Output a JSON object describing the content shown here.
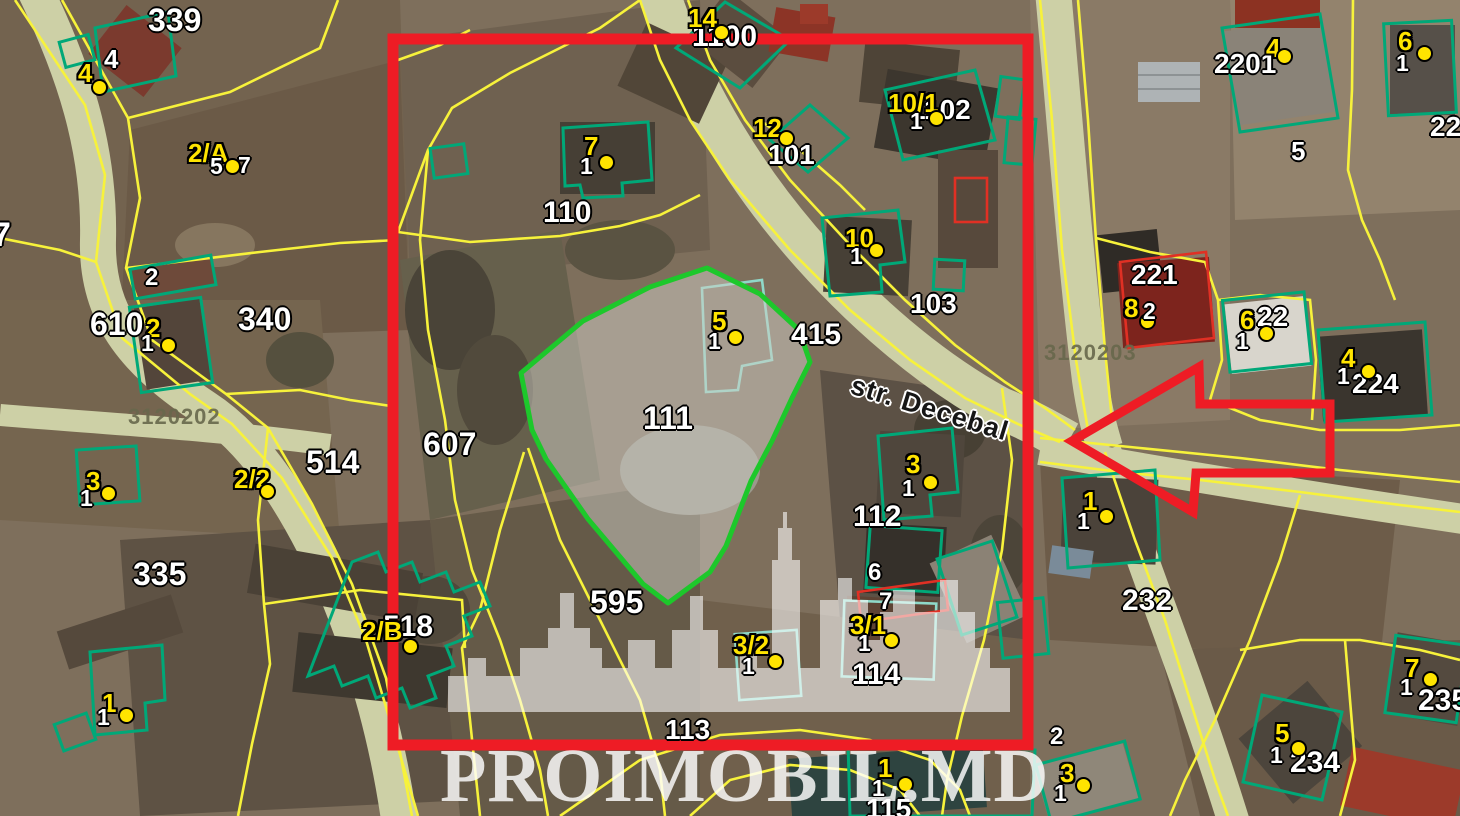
{
  "map": {
    "street_label": "str. Decebal",
    "watermark": {
      "text": "PROIMOBIL.MD"
    },
    "zone_codes": [
      {
        "text": "3120202",
        "x": 128,
        "y": 406
      },
      {
        "text": "3120203",
        "x": 1044,
        "y": 342
      }
    ],
    "colors": {
      "boundary_yellow": "#f7f23b",
      "outline_green": "#00a878",
      "outline_teal": "#8fd8c8",
      "highlight_green": "#1dc82b",
      "alert_red": "#ee1c25",
      "marker_yellow": "#ffe400",
      "label_white": "#ffffff",
      "zone_code_olive": "#68684c",
      "road": "#cdd0a6"
    },
    "markers": [
      {
        "label": "4",
        "lx": 78,
        "ly": 60,
        "dx": 99,
        "dy": 87,
        "subs": []
      },
      {
        "label": "2/A",
        "lx": 188,
        "ly": 140,
        "dx": 232,
        "dy": 166,
        "subs": [
          {
            "t": "5",
            "x": 210,
            "y": 155
          },
          {
            "t": "7",
            "x": 238,
            "y": 154
          }
        ]
      },
      {
        "label": "2",
        "lx": 146,
        "ly": 315,
        "dx": 168,
        "dy": 345,
        "subs": [
          {
            "t": "1",
            "x": 141,
            "y": 332
          }
        ]
      },
      {
        "label": "3",
        "lx": 86,
        "ly": 468,
        "dx": 108,
        "dy": 493,
        "subs": [
          {
            "t": "1",
            "x": 80,
            "y": 487
          }
        ]
      },
      {
        "label": "2/2",
        "lx": 234,
        "ly": 466,
        "dx": 267,
        "dy": 491,
        "subs": []
      },
      {
        "label": "1",
        "lx": 102,
        "ly": 690,
        "dx": 126,
        "dy": 715,
        "subs": [
          {
            "t": "1",
            "x": 97,
            "y": 706
          }
        ]
      },
      {
        "label": "14",
        "lx": 688,
        "ly": 5,
        "dx": 721,
        "dy": 32,
        "subs": []
      },
      {
        "label": "7",
        "lx": 584,
        "ly": 133,
        "dx": 606,
        "dy": 162,
        "subs": [
          {
            "t": "1",
            "x": 580,
            "y": 155
          }
        ]
      },
      {
        "label": "12",
        "lx": 753,
        "ly": 115,
        "dx": 786,
        "dy": 138,
        "subs": []
      },
      {
        "label": "10/1",
        "lx": 888,
        "ly": 90,
        "dx": 936,
        "dy": 118,
        "subs": [
          {
            "t": "1",
            "x": 910,
            "y": 110
          }
        ]
      },
      {
        "label": "10",
        "lx": 845,
        "ly": 225,
        "dx": 876,
        "dy": 250,
        "subs": [
          {
            "t": "1",
            "x": 850,
            "y": 245
          }
        ]
      },
      {
        "label": "5",
        "lx": 712,
        "ly": 308,
        "dx": 735,
        "dy": 337,
        "subs": [
          {
            "t": "1",
            "x": 708,
            "y": 330
          }
        ]
      },
      {
        "label": "3",
        "lx": 906,
        "ly": 451,
        "dx": 930,
        "dy": 482,
        "subs": [
          {
            "t": "1",
            "x": 902,
            "y": 477
          }
        ]
      },
      {
        "label": "3/1",
        "lx": 850,
        "ly": 612,
        "dx": 891,
        "dy": 640,
        "subs": [
          {
            "t": "1",
            "x": 858,
            "y": 632
          }
        ]
      },
      {
        "label": "3/2",
        "lx": 733,
        "ly": 632,
        "dx": 775,
        "dy": 661,
        "subs": [
          {
            "t": "1",
            "x": 742,
            "y": 655
          }
        ]
      },
      {
        "label": "2/B",
        "lx": 362,
        "ly": 618,
        "dx": 410,
        "dy": 646,
        "subs": []
      },
      {
        "label": "1",
        "lx": 878,
        "ly": 755,
        "dx": 905,
        "dy": 784,
        "subs": [
          {
            "t": "1",
            "x": 872,
            "y": 777
          }
        ]
      },
      {
        "label": "3",
        "lx": 1060,
        "ly": 760,
        "dx": 1083,
        "dy": 785,
        "subs": [
          {
            "t": "1",
            "x": 1054,
            "y": 782
          }
        ]
      },
      {
        "label": "8",
        "lx": 1124,
        "ly": 295,
        "dx": 1147,
        "dy": 321,
        "subs": [
          {
            "t": "2",
            "x": 1143,
            "y": 300
          }
        ]
      },
      {
        "label": "6",
        "lx": 1398,
        "ly": 28,
        "dx": 1424,
        "dy": 53,
        "subs": [
          {
            "t": "1",
            "x": 1396,
            "y": 52
          }
        ]
      },
      {
        "label": "4",
        "lx": 1266,
        "ly": 35,
        "dx": 1284,
        "dy": 56,
        "subs": []
      },
      {
        "label": "6",
        "lx": 1240,
        "ly": 307,
        "dx": 1266,
        "dy": 333,
        "subs": [
          {
            "t": "1",
            "x": 1236,
            "y": 330
          }
        ]
      },
      {
        "label": "4",
        "lx": 1341,
        "ly": 345,
        "dx": 1368,
        "dy": 371,
        "subs": [
          {
            "t": "1",
            "x": 1337,
            "y": 365
          }
        ]
      },
      {
        "label": "1",
        "lx": 1083,
        "ly": 488,
        "dx": 1106,
        "dy": 516,
        "subs": [
          {
            "t": "1",
            "x": 1077,
            "y": 510
          }
        ]
      },
      {
        "label": "7",
        "lx": 1405,
        "ly": 655,
        "dx": 1430,
        "dy": 679,
        "subs": [
          {
            "t": "1",
            "x": 1400,
            "y": 676
          }
        ]
      },
      {
        "label": "5",
        "lx": 1275,
        "ly": 720,
        "dx": 1298,
        "dy": 748,
        "subs": [
          {
            "t": "1",
            "x": 1270,
            "y": 744
          }
        ]
      }
    ],
    "parcel_labels": [
      {
        "t": "7",
        "x": -8,
        "y": 218,
        "s": 34
      },
      {
        "t": "339",
        "x": 148,
        "y": 4,
        "s": 32
      },
      {
        "t": "4",
        "x": 104,
        "y": 46,
        "s": 26
      },
      {
        "t": "2",
        "x": 145,
        "y": 266,
        "s": 24
      },
      {
        "t": "610",
        "x": 90,
        "y": 308,
        "s": 32
      },
      {
        "t": "340",
        "x": 238,
        "y": 303,
        "s": 32
      },
      {
        "t": "514",
        "x": 306,
        "y": 446,
        "s": 32
      },
      {
        "t": "335",
        "x": 133,
        "y": 558,
        "s": 32
      },
      {
        "t": "607",
        "x": 423,
        "y": 428,
        "s": 32
      },
      {
        "t": "110",
        "x": 543,
        "y": 198,
        "s": 30
      },
      {
        "t": "1100",
        "x": 692,
        "y": 22,
        "s": 30
      },
      {
        "t": "101",
        "x": 768,
        "y": 141,
        "s": 28
      },
      {
        "t": "1102",
        "x": 910,
        "y": 96,
        "s": 28
      },
      {
        "t": "103",
        "x": 910,
        "y": 290,
        "s": 28
      },
      {
        "t": "415",
        "x": 791,
        "y": 320,
        "s": 30
      },
      {
        "t": "111",
        "x": 643,
        "y": 402,
        "s": 32
      },
      {
        "t": "595",
        "x": 590,
        "y": 586,
        "s": 32
      },
      {
        "t": "518",
        "x": 383,
        "y": 612,
        "s": 30
      },
      {
        "t": "112",
        "x": 853,
        "y": 502,
        "s": 30
      },
      {
        "t": "6",
        "x": 868,
        "y": 561,
        "s": 24
      },
      {
        "t": "7",
        "x": 879,
        "y": 590,
        "s": 24
      },
      {
        "t": "114",
        "x": 852,
        "y": 660,
        "s": 30
      },
      {
        "t": "113",
        "x": 665,
        "y": 716,
        "s": 28
      },
      {
        "t": "115",
        "x": 866,
        "y": 795,
        "s": 28
      },
      {
        "t": "2",
        "x": 1050,
        "y": 725,
        "s": 24
      },
      {
        "t": "221",
        "x": 1131,
        "y": 261,
        "s": 28
      },
      {
        "t": "22",
        "x": 1257,
        "y": 303,
        "s": 28
      },
      {
        "t": "224",
        "x": 1352,
        "y": 370,
        "s": 28
      },
      {
        "t": "232",
        "x": 1122,
        "y": 586,
        "s": 30
      },
      {
        "t": "2201",
        "x": 1214,
        "y": 50,
        "s": 28
      },
      {
        "t": "5",
        "x": 1291,
        "y": 138,
        "s": 26
      },
      {
        "t": "222",
        "x": 1430,
        "y": 113,
        "s": 28
      },
      {
        "t": "235",
        "x": 1418,
        "y": 686,
        "s": 30
      },
      {
        "t": "234",
        "x": 1290,
        "y": 748,
        "s": 30
      }
    ]
  }
}
